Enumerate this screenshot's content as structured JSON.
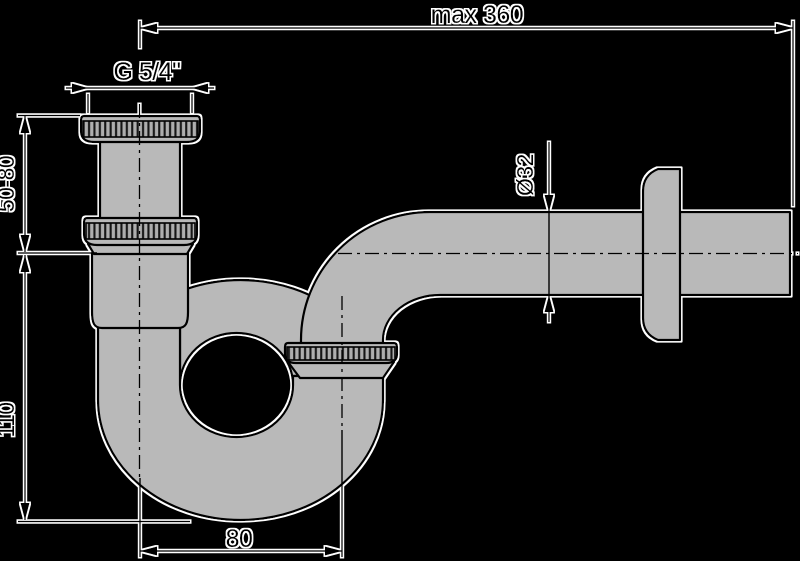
{
  "diagram": {
    "type": "technical-drawing",
    "labels": {
      "max_width": "max 360",
      "thread_size": "G 5/4\"",
      "adjust_range": "50-80",
      "trap_depth": "110",
      "pipe_diameter": "Ø32",
      "trap_offset": "80"
    },
    "colors": {
      "background": "#000000",
      "pipe_fill": "#b9b9b9",
      "line": "#000000",
      "halo": "#ffffff"
    }
  }
}
